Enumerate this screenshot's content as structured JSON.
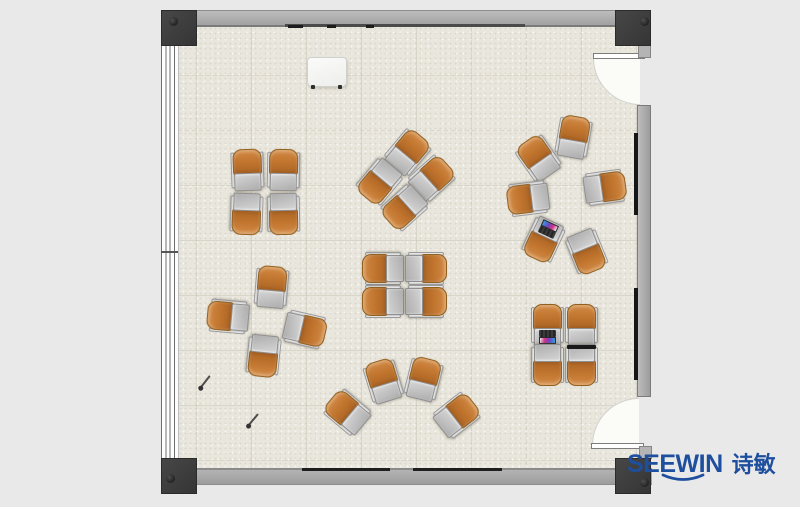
{
  "logo": {
    "brand": "SEEWIN",
    "brand_cjk": "诗敏",
    "color": "#1e4e9e"
  },
  "palette": {
    "background": "#e9e9e9",
    "floor": "#e9e6dd",
    "wall_gray": "#a8a8a8",
    "post_dark": "#3a3a3a",
    "chair_orange": "#c1752e",
    "desk_gray": "#bcbcbc",
    "door_white": "#fbfbf8",
    "laptop_screen": [
      "#d63384",
      "#6f42c1",
      "#2f9fe0"
    ]
  },
  "furniture": {
    "unit_size": {
      "width": 33,
      "height": 43
    },
    "clusters": [
      {
        "name": "cluster-top-left-grid",
        "units": [
          [
            247,
            170,
            -2,
            null
          ],
          [
            283,
            170,
            1,
            null
          ],
          [
            246,
            213,
            182,
            null
          ],
          [
            283,
            213,
            179,
            null
          ]
        ]
      },
      {
        "name": "cluster-top-center-pinwheel",
        "units": [
          [
            407,
            152,
            40,
            null
          ],
          [
            431,
            178,
            48,
            null
          ],
          [
            379,
            181,
            220,
            null
          ],
          [
            404,
            207,
            228,
            null
          ]
        ]
      },
      {
        "name": "cluster-ring-of-six",
        "units": [
          [
            573,
            137,
            10,
            null
          ],
          [
            538,
            158,
            -35,
            null
          ],
          [
            528,
            198,
            -97,
            null
          ],
          [
            604,
            187,
            82,
            null
          ],
          [
            543,
            239,
            -155,
            "open"
          ],
          [
            586,
            251,
            158,
            null
          ]
        ]
      },
      {
        "name": "cluster-center-grid",
        "units": [
          [
            383,
            268,
            -90,
            null
          ],
          [
            425,
            268,
            90,
            null
          ],
          [
            383,
            301,
            -90,
            null
          ],
          [
            425,
            301,
            90,
            null
          ]
        ]
      },
      {
        "name": "cluster-bottom-left-pinwheel",
        "units": [
          [
            271,
            287,
            5,
            null
          ],
          [
            228,
            316,
            -85,
            null
          ],
          [
            304,
            329,
            103,
            null
          ],
          [
            263,
            355,
            -174,
            null
          ]
        ]
      },
      {
        "name": "cluster-bottom-fan",
        "units": [
          [
            347,
            412,
            -50,
            null
          ],
          [
            383,
            381,
            -17,
            null
          ],
          [
            423,
            379,
            14,
            null
          ],
          [
            456,
            415,
            52,
            null
          ]
        ]
      },
      {
        "name": "cluster-bottom-right-grid",
        "units": [
          [
            547,
            325,
            0,
            "open"
          ],
          [
            581,
            325,
            0,
            null
          ],
          [
            547,
            364,
            180,
            null
          ],
          [
            581,
            364,
            180,
            "closed"
          ]
        ]
      }
    ],
    "props": {
      "whiteboard": {
        "x": 307,
        "y": 57,
        "w": 38,
        "h": 28
      },
      "pens": [
        [
          205,
          382,
          38
        ],
        [
          253,
          420,
          40
        ]
      ]
    }
  },
  "wall_fixtures": {
    "top_ticks": [
      [
        288,
        15
      ],
      [
        327,
        9
      ],
      [
        366,
        8
      ]
    ],
    "bottom_rails": [
      [
        302,
        88
      ],
      [
        413,
        89
      ]
    ],
    "right_rails": [
      [
        133,
        82
      ],
      [
        288,
        92
      ]
    ]
  }
}
